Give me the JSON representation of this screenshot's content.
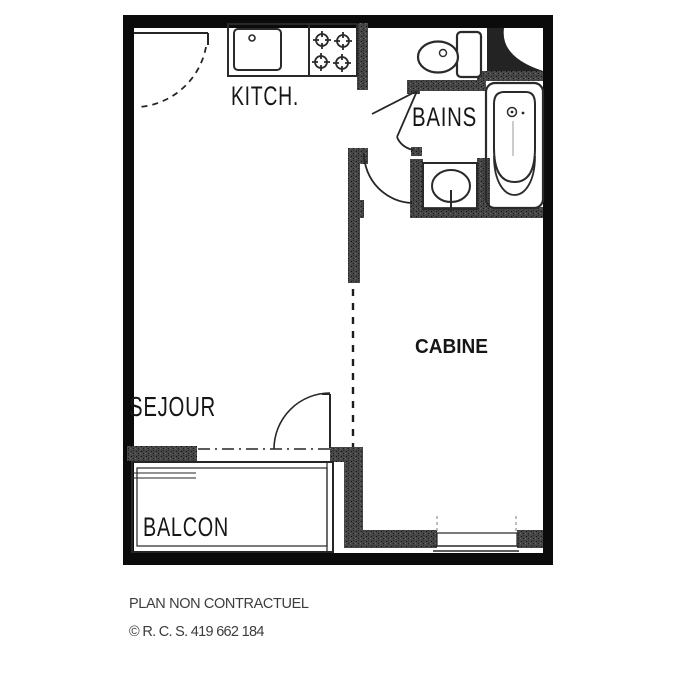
{
  "floor_plan": {
    "rooms": [
      {
        "label": "KITCH."
      },
      {
        "label": "BAINS"
      },
      {
        "label": "CABINE"
      },
      {
        "label": "SEJOUR"
      },
      {
        "label": "BALCON"
      }
    ],
    "fixtures": [
      "kitchen-sink-icon",
      "stove-burners-icon",
      "toilet-icon",
      "bathtub-icon",
      "washbasin-icon",
      "duct-shaft-icon",
      "entrance-door-icon",
      "bathroom-door-icon",
      "cabin-door-icon",
      "balcony-door-icon",
      "cabin-window-icon",
      "balcony-railing-icon"
    ],
    "footer": {
      "line1": "PLAN NON CONTRACTUEL",
      "line2": "© R. C. S. 419 662 184"
    },
    "colors": {
      "wall": "#0b0b0b",
      "partition": "#3f3f3f",
      "line": "#2a2a2a",
      "label_text": "#161616",
      "footer_text": "#3d3d3d",
      "background": "#ffffff"
    }
  }
}
